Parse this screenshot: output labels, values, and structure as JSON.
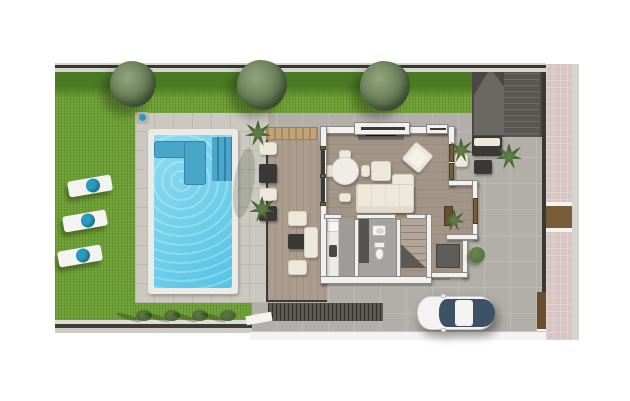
{
  "palette": {
    "grass": "#6fa035",
    "hedge": "#4a7a24",
    "treeLight": "#93a47e",
    "treeDark": "#47593b",
    "poolWater": "#8edcf0",
    "poolWaterDeep": "#55c3e4",
    "poolStep": "#4aa6c8",
    "coping": "#eceae4",
    "deckPaver": "#cbc8c1",
    "pavement": "#b2aea8",
    "courtDark": "#4b4744",
    "wall": "#f2f1ee",
    "wallEdge": "#8a8884",
    "wood": "#ab9c8e",
    "floorWood": "#a29486",
    "cream": "#eee8db",
    "darkFurniture": "#3b3936",
    "grayFloor": "#9e9c99",
    "glassDark": "#3a3a38",
    "brown": "#7a5c38",
    "planter": "#6b4e30",
    "tan": "#c2a377",
    "pinkSidewalk": "#d8c4c4",
    "curb": "#d6d4cf",
    "white": "#f4f3f1",
    "teal": "#2a9cc4",
    "carGlass": "#3d5265",
    "bushGreen": "#4e6b38",
    "mat": "#5f5d59",
    "slatWall": "#5c5854"
  },
  "scene": {
    "description": "Top-down 3D architectural floor plan of a villa plot with lawn, swimming pool, wood terrace, ground-floor rooms, external staircase, driveway with parked car and pink sidewalk",
    "garden": {
      "trees": [
        {
          "cx": 133,
          "cy": 84,
          "d": 46
        },
        {
          "cx": 262,
          "cy": 85,
          "d": 50
        },
        {
          "cx": 385,
          "cy": 86,
          "d": 50
        }
      ],
      "loungers": [
        {
          "x": 68,
          "y": 178
        },
        {
          "x": 63,
          "y": 213
        },
        {
          "x": 58,
          "y": 248
        }
      ],
      "bushes": [
        {
          "cx": 144,
          "cy": 315
        },
        {
          "cx": 172,
          "cy": 315
        },
        {
          "cx": 200,
          "cy": 315
        },
        {
          "cx": 228,
          "cy": 315
        }
      ],
      "palms": [
        {
          "cx": 258,
          "cy": 133,
          "d": 26
        },
        {
          "cx": 262,
          "cy": 209,
          "d": 26
        },
        {
          "cx": 461,
          "cy": 150,
          "d": 24
        },
        {
          "cx": 509,
          "cy": 156,
          "d": 26
        },
        {
          "cx": 454,
          "cy": 220,
          "d": 22
        }
      ]
    },
    "pool": {
      "features": [
        "corner-bench",
        "entry-steps",
        "outdoor-shower"
      ]
    },
    "house": {
      "rooms": [
        "living-dining-room",
        "kitchen",
        "bathroom",
        "staircase",
        "entry-hall"
      ],
      "furniture": [
        "tv-console",
        "round-dining-table",
        "l-shaped-sofa",
        "armchair",
        "coffee-table",
        "toilet",
        "washbasin",
        "kitchen-counter"
      ]
    },
    "exterior": {
      "items": [
        "wood-terrace",
        "outdoor-lounge-set",
        "external-staircase",
        "driveway",
        "parked-car",
        "pink-sidewalk",
        "pedestrian-gate"
      ]
    }
  }
}
